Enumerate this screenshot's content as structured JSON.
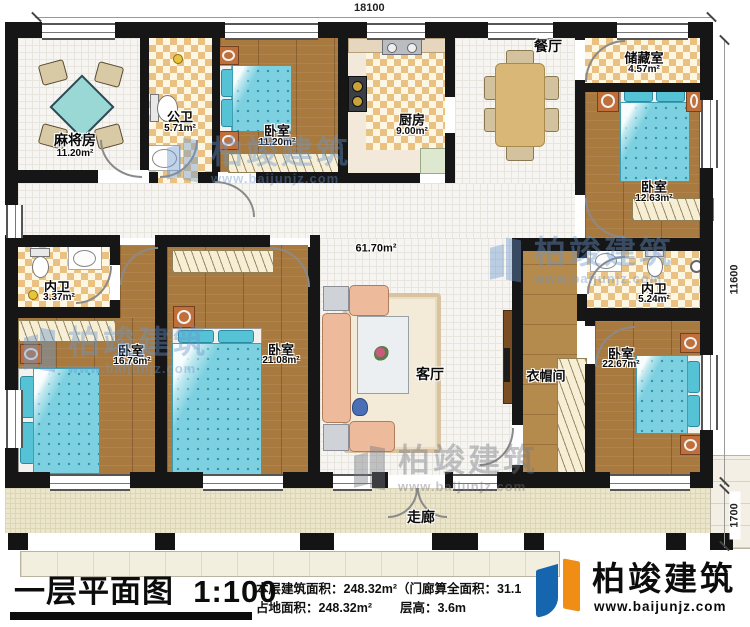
{
  "dimensions": {
    "top": "18100",
    "right_main": "11600",
    "right_porch": "1700"
  },
  "rooms": {
    "mahjong": {
      "label": "麻将房",
      "area": "11.20m²"
    },
    "public_bath": {
      "label": "公卫",
      "area": "5.71m²"
    },
    "bedroom_top": {
      "label": "卧室",
      "area": "11.20m²"
    },
    "kitchen": {
      "label": "厨房",
      "area": "9.00m²"
    },
    "dining": {
      "label": "餐厅"
    },
    "storage": {
      "label": "储藏室",
      "area": "4.57m²"
    },
    "bedroom_ne": {
      "label": "卧室",
      "area": "12.63m²"
    },
    "inner_bath_w": {
      "label": "内卫",
      "area": "3.37m²"
    },
    "bedroom_w": {
      "label": "卧室",
      "area": "16.76m²"
    },
    "bedroom_c": {
      "label": "卧室",
      "area": "21.08m²"
    },
    "living": {
      "label": "客厅",
      "area": "61.70m²"
    },
    "inner_bath_e": {
      "label": "内卫",
      "area": "5.24m²"
    },
    "closet": {
      "label": "衣帽间"
    },
    "bedroom_se": {
      "label": "卧室",
      "area": "22.67m²"
    },
    "corridor": {
      "label": "走廊"
    }
  },
  "footer": {
    "title": "一层平面图",
    "scale": "1:100",
    "stats_line1": "本层建筑面积：248.32m²（门廊算全面积：31.1",
    "stats_line2a": "占地面积：248.32m²",
    "stats_line2b": "层高：3.6m"
  },
  "brand": {
    "name": "柏竣建筑",
    "site": "www.baijunjz.com"
  },
  "colors": {
    "accent_blue": "#1566ae",
    "accent_orange": "#f08d15",
    "wall": "#161616"
  }
}
